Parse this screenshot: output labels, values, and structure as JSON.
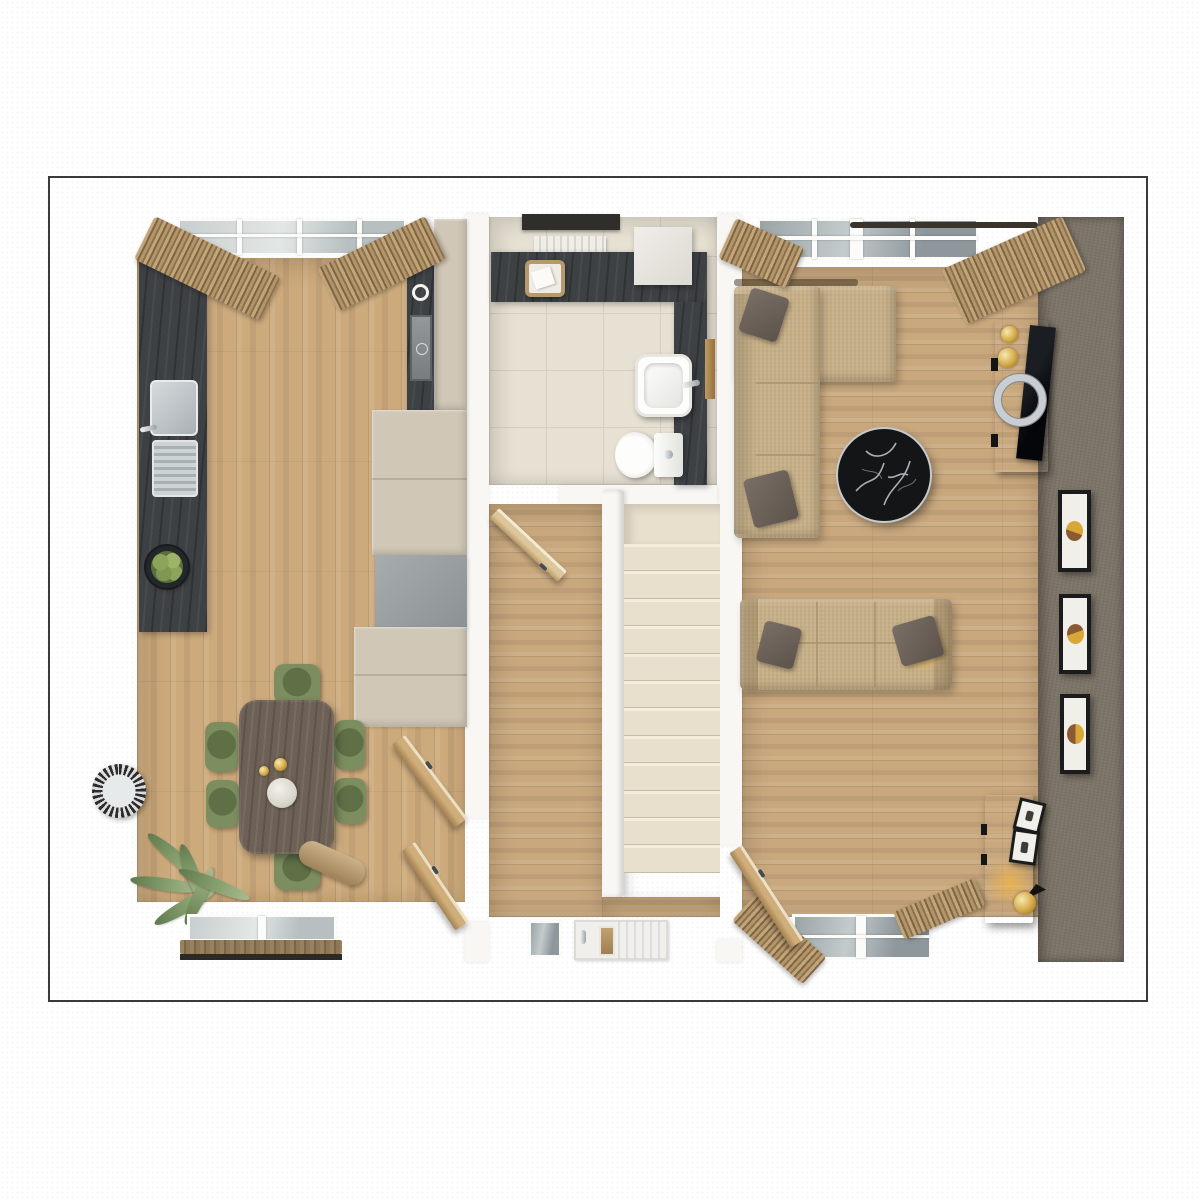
{
  "image": {
    "type": "3d-floor-plan-render",
    "view": "top-down dollhouse",
    "floor_shown": "ground floor with kitchen-dining room, hallway, bathroom, staircase and living room"
  },
  "palette": {
    "borderDark": "#3a3a38",
    "wallWhite": "#f8f7f4",
    "floorKitchen": "#cdaa7c",
    "floorLiving": "#c9a87e",
    "counterDark": "#3e4144",
    "cabinetBeige": "#d0c7b6",
    "cabinetGray": "#9aa0a2",
    "tileFloor": "#e7e1d3",
    "tileLine": "#d6cfc0",
    "stairCarpet": "#e8dfcc",
    "accentWall": "#7c7467",
    "sofaBeige": "#c7b087",
    "sofaSeam": "#a8916b",
    "pillowGray": "#6b635c",
    "chairGreen": "#7c8d5f",
    "chairGreenDark": "#5f7046",
    "tableWood": "#6d6156",
    "doorWood": "#b98f5f",
    "curtainTan": "#b49a75",
    "marbleBlack": "#141517",
    "consoleWood": "#30271e",
    "sideboardWood": "#4a4038",
    "frameBlack": "#1b1b1b",
    "artGold": "#d9a638",
    "artBrown": "#8a5a33",
    "chromeSilver": "#c9ced2",
    "glassTop": "#9aa3a6",
    "glassBottom": "#b9c1bf",
    "apples": "#8aa45a"
  },
  "scene": {
    "rooms": [
      {
        "id": "kitchen-dining",
        "floor": "wood-vertical-planks",
        "items": [
          "dark-counter-with-sink",
          "fruit-bowl",
          "hob-oven-column",
          "beige-cabinets",
          "dining-table",
          "dining-chairs",
          "wall-mirror",
          "potted-palm",
          "rear-window-with-curtains",
          "front-window-with-pelmet"
        ]
      },
      {
        "id": "bathroom",
        "floor": "ceramic-tiles",
        "items": [
          "window-blind",
          "radiator",
          "vanity-counter",
          "towel-basket",
          "wall-cabinet",
          "washbasin",
          "toilet",
          "open-door"
        ]
      },
      {
        "id": "hallway",
        "floor": "wood-horizontal-planks",
        "items": [
          "staircase",
          "banister",
          "front-door",
          "sidelight-window"
        ]
      },
      {
        "id": "living-room",
        "floor": "wood-horizontal-planks",
        "items": [
          "corner-sofa",
          "three-seat-sofa",
          "throw-pillows",
          "marble-coffee-table",
          "tv-console",
          "tv-screen",
          "silver-ring-decor",
          "accent-wall",
          "wall-art-frames",
          "sideboard",
          "leaning-frames",
          "floor-lamp",
          "windows-with-curtains",
          "open-door"
        ]
      }
    ],
    "staircase": {
      "step_count": 12,
      "landing": true
    },
    "dining": {
      "chair_count": 6,
      "table_decor": [
        "candles",
        "white-vase"
      ]
    },
    "wall_art": {
      "framed_count": 3,
      "leaning_count": 2
    },
    "open_interior_doors": 4
  }
}
